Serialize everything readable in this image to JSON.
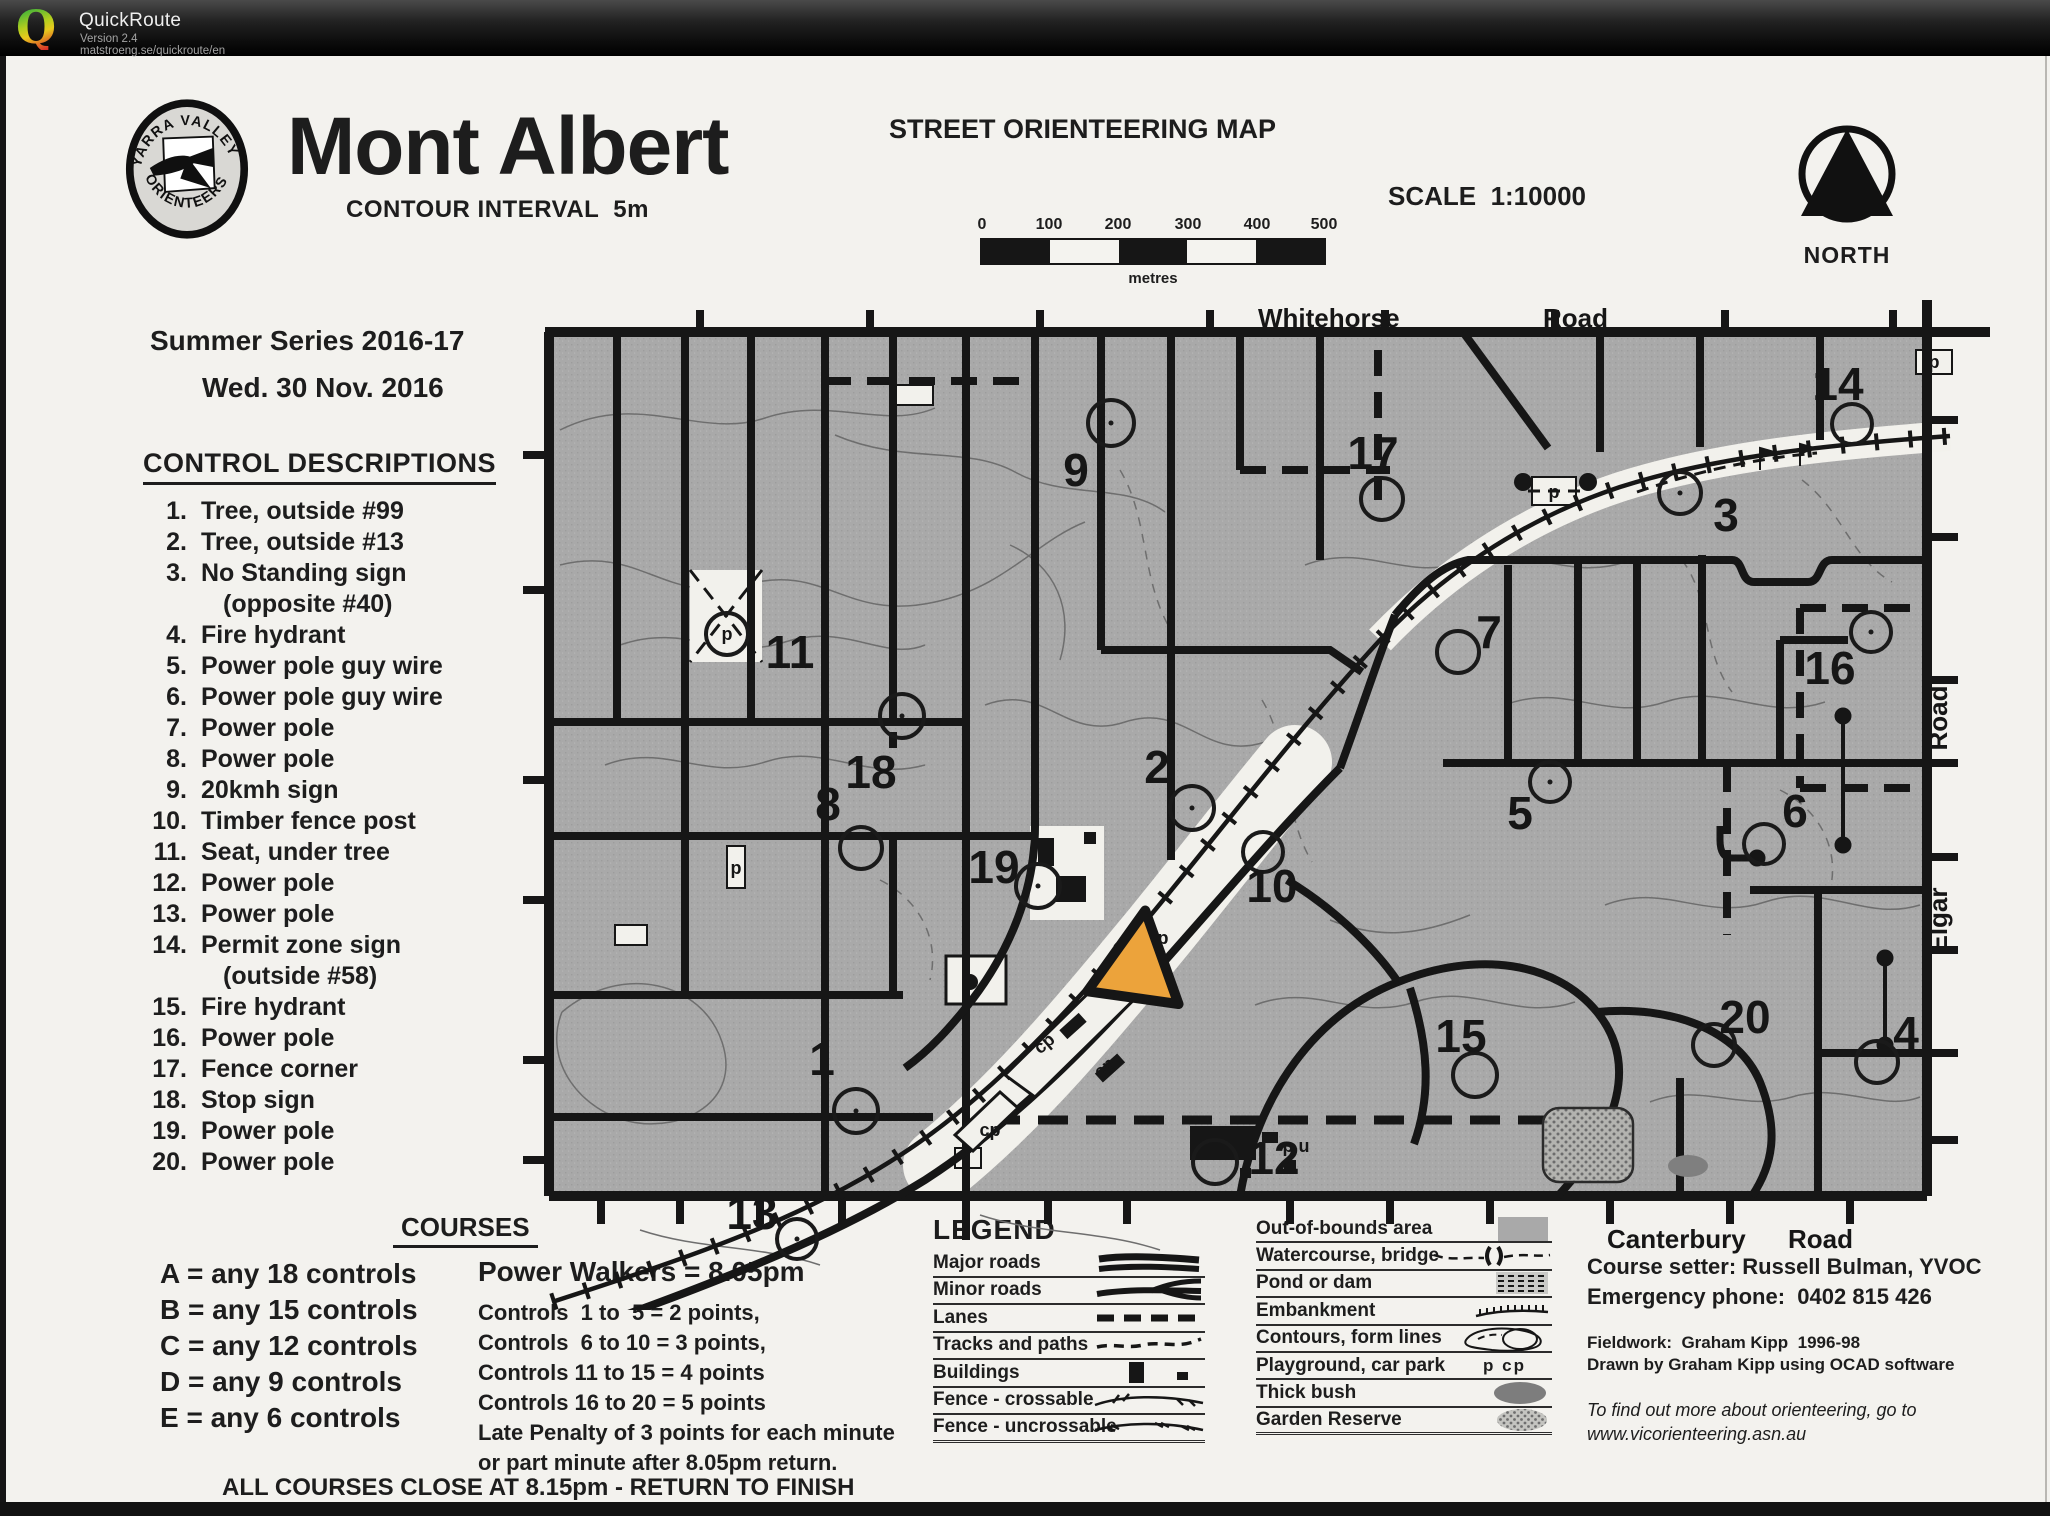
{
  "app": {
    "name": "QuickRoute",
    "version": "Version 2.4",
    "url": "matstroeng.se/quickroute/en"
  },
  "masthead": {
    "title": "Mont Albert",
    "contour": "CONTOUR INTERVAL  5m",
    "map_type": "STREET ORIENTEERING MAP",
    "scale": "SCALE  1:10000",
    "north": "NORTH",
    "series": "Summer Series 2016-17",
    "date": "Wed. 30 Nov. 2016",
    "club_arc_top": "YARRA VALLEY",
    "club_arc_bottom": "ORIENTEERS"
  },
  "scale_bar": {
    "ticks": [
      "0",
      "100",
      "200",
      "300",
      "400",
      "500"
    ],
    "unit": "metres"
  },
  "controls": {
    "heading": "CONTROL DESCRIPTIONS",
    "items": [
      {
        "num": "1.",
        "text": "Tree, outside #99"
      },
      {
        "num": "2.",
        "text": "Tree, outside #13"
      },
      {
        "num": "3.",
        "text": "No Standing sign",
        "text2": "(opposite #40)"
      },
      {
        "num": "4.",
        "text": "Fire hydrant"
      },
      {
        "num": "5.",
        "text": "Power pole guy wire"
      },
      {
        "num": "6.",
        "text": "Power pole guy wire"
      },
      {
        "num": "7.",
        "text": "Power pole"
      },
      {
        "num": "8.",
        "text": "Power pole"
      },
      {
        "num": "9.",
        "text": "20kmh sign"
      },
      {
        "num": "10.",
        "text": "Timber fence post"
      },
      {
        "num": "11.",
        "text": "Seat, under tree"
      },
      {
        "num": "12.",
        "text": "Power pole"
      },
      {
        "num": "13.",
        "text": "Power pole"
      },
      {
        "num": "14.",
        "text": "Permit zone sign",
        "text2": "(outside #58)"
      },
      {
        "num": "15.",
        "text": "Fire hydrant"
      },
      {
        "num": "16.",
        "text": "Power pole"
      },
      {
        "num": "17.",
        "text": "Fence corner"
      },
      {
        "num": "18.",
        "text": "Stop sign"
      },
      {
        "num": "19.",
        "text": "Power pole"
      },
      {
        "num": "20.",
        "text": "Power pole"
      }
    ]
  },
  "courses": {
    "heading": "COURSES",
    "list": [
      "A = any 18 controls",
      "B = any 15 controls",
      "C = any 12 controls",
      "D = any 9 controls",
      "E = any 6 controls"
    ],
    "walkers": "Power Walkers = 8.05pm",
    "scoring": [
      "Controls  1 to  5 = 2 points,",
      "Controls  6 to 10 = 3 points,",
      "Controls 11 to 15 = 4 points",
      "Controls 16 to 20 = 5 points",
      "Late Penalty of 3 points for each minute",
      "or part minute after 8.05pm return."
    ],
    "closing": "ALL COURSES CLOSE AT 8.15pm - RETURN TO FINISH"
  },
  "legend": {
    "heading": "LEGEND",
    "left": [
      "Major roads",
      "Minor roads",
      "Lanes",
      "Tracks and paths",
      "Buildings",
      "Fence - crossable",
      "Fence - uncrossable"
    ],
    "right": [
      "Out-of-bounds area",
      "Watercourse, bridge",
      "Pond or dam",
      "Embankment",
      "Contours, form lines",
      "Playground, car park",
      "Thick bush",
      "Garden Reserve"
    ],
    "playground_syms": "p   cp"
  },
  "credits": {
    "setter": "Course setter: Russell Bulman, YVOC",
    "emergency": "Emergency phone:  0402 815 426",
    "fieldwork": "Fieldwork:  Graham Kipp  1996-98",
    "drawn": "Drawn by Graham Kipp using OCAD software",
    "more1": "To find out more about orienteering, go to",
    "more2": "www.vicorienteering.asn.au"
  },
  "map": {
    "numbers": [
      "1",
      "2",
      "3",
      "4",
      "5",
      "6",
      "7",
      "8",
      "9",
      "10",
      "11",
      "12",
      "13",
      "14",
      "15",
      "16",
      "17",
      "18",
      "19",
      "20"
    ],
    "roads": {
      "whitehorse": "Whitehorse",
      "road_top": "Road",
      "canterbury": "Canterbury",
      "road_bottom": "Road",
      "elgar": "Elgar",
      "road_right": "Road"
    },
    "label_p": "p",
    "label_cp": "cp",
    "label_pu": "p u"
  },
  "colors": {
    "start_orange": "#eca33b",
    "map_gray": "#a9a9a9",
    "header_bg": "#141414"
  }
}
